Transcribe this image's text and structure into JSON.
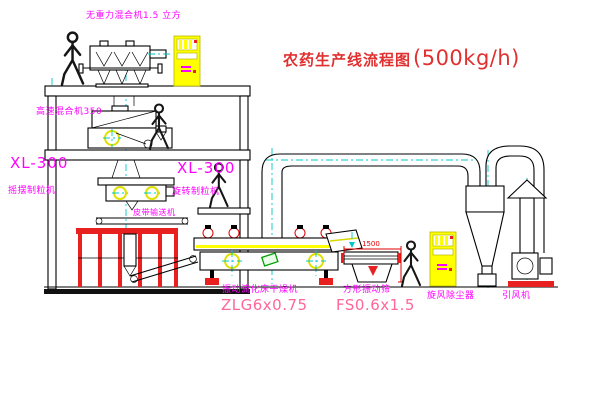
{
  "title": {
    "text": "农药生产线流程图",
    "capacity": "(500kg/h)"
  },
  "equipment_labels": {
    "gravity_mixer": "无重力混合机1.5 立方",
    "high_speed_mixer": "高速混合机350",
    "granulator_left_model": "XL-300",
    "granulator_left_name": "摇摆制粒机",
    "granulator_right_model": "XL-300",
    "granulator_right_name": "旋转制粒机",
    "belt_conveyor": "皮带输送机",
    "dryer_name": "振动流化床干燥机",
    "dryer_model": "ZLG6x0.75",
    "screen_name": "方形振动筛",
    "screen_model": "FS0.6x1.5",
    "cyclone": "旋风除尘器",
    "fan": "引风机"
  },
  "dimensions": {
    "screen_width": "1500"
  },
  "colors": {
    "label_magenta": "#FF00FF",
    "title_red": "#E03030",
    "model_pink": "#FF6699",
    "outline_black": "#000000",
    "centerline_cyan": "#00C8C8",
    "accent_red": "#E82020",
    "cabinet_yellow": "#FFFF00",
    "highlight_green": "#00A000"
  }
}
